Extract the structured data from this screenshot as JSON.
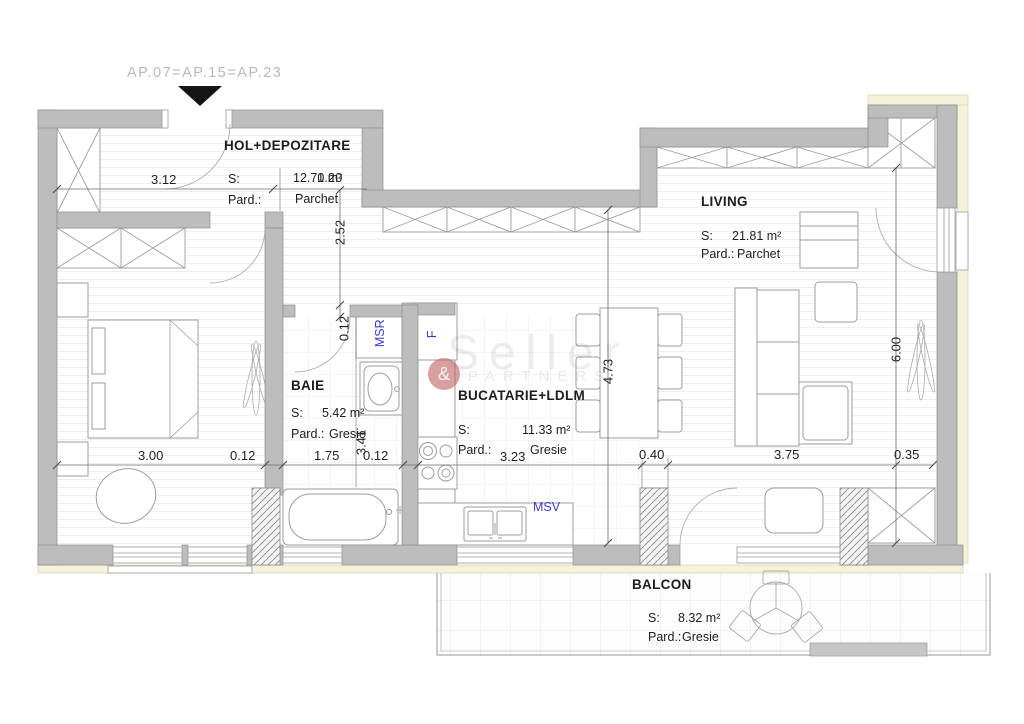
{
  "meta": {
    "apartment_label": "AP.07=AP.15=AP.23"
  },
  "watermark": {
    "brand": "Seller",
    "amp": "&",
    "sub": "PARTNERS"
  },
  "labels": {
    "area": "S:",
    "floor": "Pard.:"
  },
  "rooms": {
    "hall": {
      "name": "HOL+DEPOZITARE",
      "area": "12.70 m²",
      "floor": "Parchet"
    },
    "living": {
      "name": "LIVING",
      "area": "21.81 m²",
      "floor": "Parchet"
    },
    "bath": {
      "name": "BAIE",
      "area": "5.42 m²",
      "floor": "Gresie"
    },
    "kitchen": {
      "name": "BUCATARIE+LDLM",
      "area": "11.33 m²",
      "floor": "Gresie"
    },
    "balcony": {
      "name": "BALCON",
      "area": "8.32 m²",
      "floor": "Gresie"
    }
  },
  "appliances": {
    "washer": "MSR",
    "fridge": "F",
    "dishwasher": "MSV"
  },
  "dims": {
    "hall_w": "3.12",
    "hall_d": "2.52",
    "door_w": "1.20",
    "bed_w": "3.00",
    "wall_a": "0.12",
    "bath_w": "1.75",
    "wall_b": "0.12",
    "wall_v": "0.12",
    "bath_d": "3.41",
    "kitchen_w": "3.23",
    "kitchen_d": "4.73",
    "col_w": "0.40",
    "living_w": "3.75",
    "living_d": "6.00",
    "wall_r": "0.35"
  },
  "colors": {
    "wall": "#bdbdbd",
    "accent_blue": "#3d3dc9",
    "exterior": "#f5f1da",
    "watermark_pink": "#c16060"
  }
}
